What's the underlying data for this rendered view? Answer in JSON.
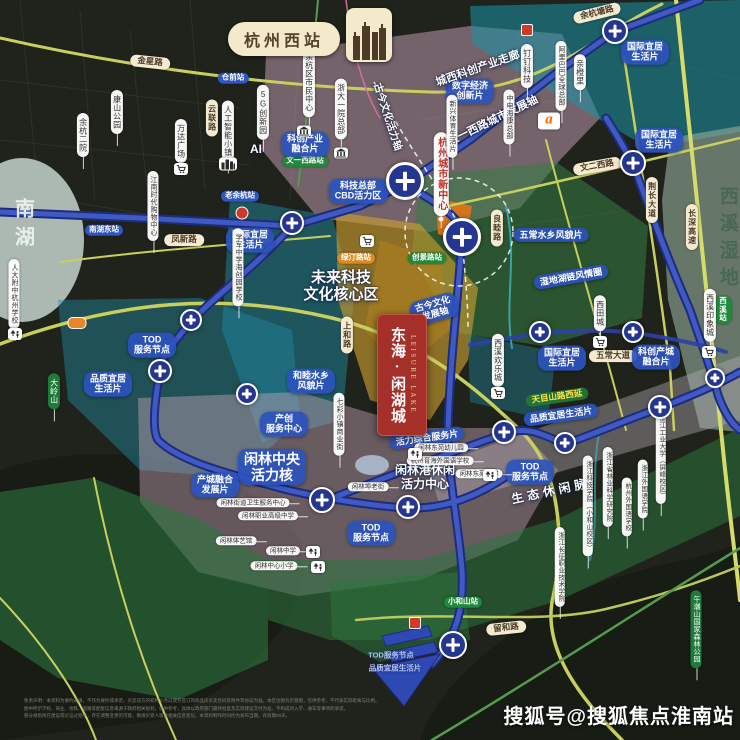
{
  "header": {
    "station_title": "杭州西站"
  },
  "banner": {
    "cn": "东海·闲湖城",
    "en": "LEISURE LAKE"
  },
  "footer": {
    "watermark": "搜狐号@搜狐焦点淮南站",
    "disclaimer_lines": [
      "免责声明：本资料为要约邀请，不作为要约或承诺，买卖双方的权利义务以双方签订的商品房买卖合同及附件等协议为准。本区位图为示意图，仅供参考，不代表实际距离与比例。",
      "图中所示学校、商业、地铁、道路等配套信息来源于政府相关规划，仅供参考，具体以政府部门最终批复及实际建设交付为准，不构成对入学、通车等事项的承诺。",
      "部分规划尚在建设或论证过程中，存在调整变更的可能，敬请买受人留意相关信息变化。本资料制作时间约为发布当期，有效期30天。"
    ]
  },
  "colors": {
    "banner_red": "#a5302a",
    "metro_blue": "#2c41a8",
    "metro_blue_light": "#4159c2",
    "label_blue": "#2b52be",
    "station_green": "#1f8a3c",
    "station_orange": "#e08a1e",
    "station_blue": "#2f55c0",
    "road_yellow": "#c9cf5e",
    "pill_cream": "#f3ead0",
    "wetland_text": "#4a6655"
  },
  "labels": [
    {
      "n": "road-label-jinxinglu",
      "k": "road",
      "t": "金星路",
      "x": 150,
      "y": 62,
      "r": 6
    },
    {
      "n": "road-label-yuhangtanglu",
      "k": "road",
      "t": "余杭塘路",
      "x": 597,
      "y": 13,
      "r": -14
    },
    {
      "n": "road-label-wenerxilu",
      "k": "road",
      "t": "文二西路",
      "x": 597,
      "y": 166,
      "r": -10
    },
    {
      "n": "road-label-fengxinlu",
      "k": "road",
      "t": "凤新路",
      "x": 184,
      "y": 240,
      "r": 0
    },
    {
      "n": "road-label-wuchangdadao",
      "k": "road",
      "t": "五常大道",
      "x": 613,
      "y": 356,
      "r": 0
    },
    {
      "n": "road-label-liuhelu",
      "k": "road",
      "t": "留和路",
      "x": 506,
      "y": 628,
      "r": -6
    },
    {
      "n": "road-label-liangmulu",
      "k": "vroad",
      "t": "良睦路",
      "x": 497,
      "y": 228
    },
    {
      "n": "road-label-jingchangdadao",
      "k": "vroad",
      "t": "荆长大道",
      "x": 652,
      "y": 200
    },
    {
      "n": "road-label-changshengaosu",
      "k": "vroad",
      "t": "长深高速",
      "x": 692,
      "y": 227
    },
    {
      "n": "road-label-shanghelu",
      "k": "vroad",
      "t": "上和路",
      "x": 347,
      "y": 335
    },
    {
      "n": "road-label-yunlianlu",
      "k": "vroad",
      "t": "云联路",
      "x": 212,
      "y": 118
    },
    {
      "n": "station-pill-wenyixilu",
      "k": "st",
      "t": "文一西路站",
      "x": 305,
      "y": 161,
      "c": "g"
    },
    {
      "n": "station-pill-lvtinglu",
      "k": "st",
      "t": "绿汀路站",
      "x": 356,
      "y": 258,
      "c": "o"
    },
    {
      "n": "station-pill-chuangjinglu",
      "k": "st",
      "t": "创景路站",
      "x": 427,
      "y": 258,
      "c": "g"
    },
    {
      "n": "station-pill-xiaoheshan",
      "k": "st",
      "t": "小和山站",
      "x": 463,
      "y": 602,
      "c": "g"
    },
    {
      "n": "station-pill-xixi",
      "k": "st",
      "t": "西溪站",
      "x": 723,
      "y": 310,
      "c": "g"
    },
    {
      "n": "station-pill-nanhudong",
      "k": "st",
      "t": "南湖东站",
      "x": 104,
      "y": 230,
      "c": "b"
    },
    {
      "n": "station-pill-cangqian",
      "k": "st",
      "t": "仓前站",
      "x": 233,
      "y": 78,
      "c": "b"
    },
    {
      "n": "station-pill-laoyuhang",
      "k": "st",
      "t": "老余杭站",
      "x": 240,
      "y": 196,
      "c": "b"
    },
    {
      "n": "zone-label-intl-livable-1",
      "k": "blue",
      "t": "国际宜居\n生活片",
      "x": 645,
      "y": 52
    },
    {
      "n": "zone-label-intl-livable-2",
      "k": "blue",
      "t": "国际宜居\n生活片",
      "x": 659,
      "y": 140
    },
    {
      "n": "zone-label-digital-economy",
      "k": "blue",
      "t": "数字经济\n创新片",
      "x": 470,
      "y": 91
    },
    {
      "n": "zone-label-kechuang-industry",
      "k": "blue",
      "t": "科创产业\n融合片",
      "x": 305,
      "y": 144
    },
    {
      "n": "zone-label-intl-livable-3",
      "k": "blue",
      "t": "国际宜居\n生活片",
      "x": 250,
      "y": 240
    },
    {
      "n": "zone-label-cbd-vitality",
      "k": "blue",
      "t": "科技总部\nCBD活力区",
      "x": 358,
      "y": 191
    },
    {
      "n": "zone-label-wuchang-watertown",
      "k": "blue",
      "t": "五常水乡风貌片",
      "x": 551,
      "y": 235
    },
    {
      "n": "zone-label-wetland-ring",
      "k": "blue",
      "t": "湿地湖链风情圈",
      "x": 571,
      "y": 277,
      "r": -10
    },
    {
      "n": "zone-label-intl-livable-4",
      "k": "blue",
      "t": "国际宜居\n生活片",
      "x": 562,
      "y": 358
    },
    {
      "n": "zone-label-kechuang-city",
      "k": "blue",
      "t": "科创产城\n融合片",
      "x": 656,
      "y": 357
    },
    {
      "n": "zone-label-hemu-watertown",
      "k": "blue",
      "t": "和睦水乡\n风貌片",
      "x": 311,
      "y": 381
    },
    {
      "n": "axis-label-gujin-fazhan",
      "k": "blue",
      "t": "古今文化\n发展轴",
      "x": 434,
      "y": 309,
      "r": -16
    },
    {
      "n": "zone-label-vitality-service",
      "k": "blue",
      "t": "活力综合服务片",
      "x": 427,
      "y": 438,
      "r": -8
    },
    {
      "n": "zone-label-chanchuang-center",
      "k": "blue",
      "t": "产创\n服务中心",
      "x": 284,
      "y": 424
    },
    {
      "n": "zone-label-xianlin-core",
      "k": "blue",
      "t": "闲林中央\n活力核",
      "x": 272,
      "y": 467,
      "s": 14
    },
    {
      "n": "zone-label-chancheng-fusion",
      "k": "blue",
      "t": "产城融合\n发展片",
      "x": 215,
      "y": 485
    },
    {
      "n": "zone-label-quality-livable-1",
      "k": "blue",
      "t": "品质宜居\n生活片",
      "x": 108,
      "y": 384
    },
    {
      "n": "zone-label-tod-node-1",
      "k": "blue",
      "t": "TOD\n服务节点",
      "x": 152,
      "y": 345
    },
    {
      "n": "zone-label-tod-node-2",
      "k": "blue",
      "t": "TOD\n服务节点",
      "x": 530,
      "y": 472
    },
    {
      "n": "zone-label-tod-node-3",
      "k": "blue",
      "t": "TOD\n服务节点",
      "x": 371,
      "y": 533
    },
    {
      "n": "zone-label-quality-livable-2",
      "k": "blue",
      "t": "品质宜居生活片",
      "x": 561,
      "y": 415,
      "r": -8
    },
    {
      "n": "road-label-tianmushanlu",
      "k": "green",
      "t": "天目山路西延",
      "x": 557,
      "y": 397,
      "r": -8
    },
    {
      "n": "zone-label-tod-node-4",
      "k": "faint",
      "t": "TOD服务节点",
      "x": 391,
      "y": 656
    },
    {
      "n": "zone-label-quality-livable-3",
      "k": "faint",
      "t": "品质宜居生活片",
      "x": 395,
      "y": 669
    },
    {
      "n": "zone-label-future-tech-core",
      "k": "wtext",
      "t": "未来科技\n文化核心区",
      "x": 341,
      "y": 286,
      "s": 15
    },
    {
      "n": "zone-label-xianlingang-center",
      "k": "wtext",
      "t": "闲林港休闲\n活力中心",
      "x": 425,
      "y": 478,
      "s": 12
    },
    {
      "n": "axis-label-eco-leisure",
      "k": "wtext",
      "t": "生态休闲脉",
      "x": 551,
      "y": 492,
      "s": 12,
      "r": -12,
      "ls": 4
    },
    {
      "n": "axis-label-chengxi-corridor",
      "k": "wtext",
      "t": "城西科创产业走廊",
      "x": 478,
      "y": 69,
      "s": 11,
      "r": -19
    },
    {
      "n": "axis-label-wenyixilu-axis",
      "k": "wtext",
      "t": "文一西路城市发展轴",
      "x": 493,
      "y": 121,
      "s": 11,
      "r": -26
    },
    {
      "n": "axis-label-gujin-vitality",
      "k": "wtext",
      "t": "古今文化活力轴",
      "x": 387,
      "y": 117,
      "s": 10,
      "r": 72
    },
    {
      "n": "area-label-ai",
      "k": "wtext",
      "t": "AI",
      "x": 256,
      "y": 150,
      "s": 12
    },
    {
      "n": "lake-label-nanhu",
      "k": "vtext",
      "t": "南湖",
      "x": 22,
      "y": 226,
      "s": 20,
      "ls": 8,
      "c": "rgba(238,244,238,0.92)"
    },
    {
      "n": "wetland-label-xixi",
      "k": "vtext",
      "t": "西溪湿地",
      "x": 727,
      "y": 240,
      "s": 19,
      "ls": 8,
      "c": "#4a6655"
    },
    {
      "n": "poi-pill-hz-new-center",
      "k": "redv",
      "t": "杭州城市新中心",
      "x": 441,
      "y": 174
    },
    {
      "n": "poi-pill-kangshan-park",
      "k": "vp",
      "t": "康山公园",
      "x": 117,
      "y": 112
    },
    {
      "n": "poi-pill-yuhang-hospital",
      "k": "vp",
      "t": "余杭二院",
      "x": 83,
      "y": 135
    },
    {
      "n": "poi-pill-wanda-plaza",
      "k": "vp",
      "t": "万达广场",
      "x": 181,
      "y": 141
    },
    {
      "n": "poi-pill-ai-town",
      "k": "vp",
      "t": "人工智能小镇",
      "x": 228,
      "y": 131
    },
    {
      "n": "poi-pill-yuhang-civic-center",
      "k": "vp",
      "t": "余杭区市民中心",
      "x": 309,
      "y": 82
    },
    {
      "n": "poi-pill-5g-park",
      "k": "vp",
      "t": "5G创新园",
      "x": 263,
      "y": 112
    },
    {
      "n": "poi-pill-zheda-hospital",
      "k": "vp",
      "t": "浙大一院总部",
      "x": 341,
      "y": 109
    },
    {
      "n": "poi-pill-dingding",
      "k": "vp",
      "t": "钉钉科技",
      "x": 527,
      "y": 66
    },
    {
      "n": "poi-pill-alibaba-hq",
      "k": "vp",
      "t": "阿里巴巴全球总部",
      "x": 561,
      "y": 76,
      "s": 7
    },
    {
      "n": "poi-pill-qinchengli",
      "k": "vp",
      "t": "亲橙里",
      "x": 580,
      "y": 72
    },
    {
      "n": "poi-pill-cethik",
      "k": "vp",
      "t": "中电海康总部",
      "x": 509,
      "y": 117,
      "s": 7
    },
    {
      "n": "poi-pill-xixi-joyland",
      "k": "vp",
      "t": "西溪欢乐城",
      "x": 498,
      "y": 360
    },
    {
      "n": "poi-pill-xitiancheng",
      "k": "vp",
      "t": "西田城",
      "x": 600,
      "y": 313
    },
    {
      "n": "poi-pill-xixi-intime",
      "k": "vp",
      "t": "西溪印象城",
      "x": 710,
      "y": 315
    },
    {
      "n": "poi-pill-qicai-street",
      "k": "vp",
      "t": "七彩小镇商业街",
      "x": 339,
      "y": 424,
      "s": 7
    },
    {
      "n": "poi-pill-rendafuzhong",
      "k": "vp",
      "t": "人大附中杭州学校",
      "x": 14,
      "y": 294,
      "s": 7
    },
    {
      "n": "poi-pill-xuejun-school",
      "k": "vp",
      "t": "学军中学海创园学校",
      "x": 238,
      "y": 267,
      "s": 7
    },
    {
      "n": "poi-pill-jiangnan-mall",
      "k": "vp",
      "t": "江南时代购物中心",
      "x": 153,
      "y": 206,
      "s": 7
    },
    {
      "n": "poi-pill-sports-life",
      "k": "vp",
      "t": "新兴体育生活片",
      "x": 452,
      "y": 126,
      "s": 7
    },
    {
      "n": "poi-pill-zust",
      "k": "vp",
      "t": "浙江科技学院（小和山校区）",
      "x": 588,
      "y": 506,
      "s": 6.5
    },
    {
      "n": "poi-pill-forestry-academy",
      "k": "vp",
      "t": "浙江省林业科学研究院",
      "x": 608,
      "y": 487,
      "s": 6.5
    },
    {
      "n": "poi-pill-hangzhou-foreign-school",
      "k": "vp",
      "t": "杭州外国语学校",
      "x": 627,
      "y": 507,
      "s": 6.5
    },
    {
      "n": "poi-pill-zisu",
      "k": "vp",
      "t": "浙江外国语学院",
      "x": 643,
      "y": 489,
      "s": 6.5
    },
    {
      "n": "poi-pill-zjut",
      "k": "vp",
      "t": "浙江工业大学（屏峰校区）",
      "x": 661,
      "y": 457,
      "s": 6.5
    },
    {
      "n": "poi-pill-changzheng-college",
      "k": "vp",
      "t": "浙江长征职业技术学院",
      "x": 560,
      "y": 567,
      "s": 6.5
    },
    {
      "n": "poi-pill-daling-mountain",
      "k": "vpg",
      "t": "大岭山",
      "x": 54,
      "y": 391
    },
    {
      "n": "poi-pill-wuchaoshan-park",
      "k": "vpg",
      "t": "午潮山国家森林公园",
      "x": 696,
      "y": 629,
      "s": 7
    },
    {
      "n": "poi-pill-xianlin-health-center",
      "k": "hpill",
      "t": "闲林街道卫生服务中心",
      "x": 253,
      "y": 503
    },
    {
      "n": "poi-pill-xianlin-vocational",
      "k": "hpill",
      "t": "闲林职业高级中学",
      "x": 268,
      "y": 516
    },
    {
      "n": "poi-pill-xianlin-gym",
      "k": "hpill",
      "t": "闲林体艺馆",
      "x": 236,
      "y": 541
    },
    {
      "n": "poi-pill-xianlin-middle-school",
      "k": "hpill",
      "t": "闲林中学",
      "x": 283,
      "y": 551
    },
    {
      "n": "poi-pill-xianlin-primary",
      "k": "hpill",
      "t": "闲林中心小学",
      "x": 274,
      "y": 566
    },
    {
      "n": "poi-pill-xianlinbu-old-street",
      "k": "hpill",
      "t": "闲林埠老街",
      "x": 368,
      "y": 487
    },
    {
      "n": "poi-pill-dongyuan-kindergarten",
      "k": "hpill",
      "t": "闲林东苑幼儿园",
      "x": 441,
      "y": 448
    },
    {
      "n": "poi-pill-yuhai-school",
      "k": "hpill",
      "t": "杭州育海外国语学校",
      "x": 440,
      "y": 461
    },
    {
      "n": "poi-pill-dongyuan-primary",
      "k": "hpill",
      "t": "闲林东苑小学",
      "x": 479,
      "y": 474
    }
  ],
  "icons": [
    {
      "n": "mall-cart-icon-wanda",
      "t": "cart",
      "x": 181,
      "y": 169
    },
    {
      "n": "mall-cart-icon-cbd",
      "t": "cart",
      "x": 367,
      "y": 241
    },
    {
      "n": "mall-cart-icon-joyland",
      "t": "cart",
      "x": 498,
      "y": 393
    },
    {
      "n": "mall-cart-icon-xitiancheng",
      "t": "cart",
      "x": 600,
      "y": 342
    },
    {
      "n": "mall-cart-icon-intime",
      "t": "cart",
      "x": 709,
      "y": 352
    },
    {
      "n": "bank-building-icon-1",
      "t": "bank",
      "x": 304,
      "y": 131
    },
    {
      "n": "bank-building-icon-2",
      "t": "bank",
      "x": 341,
      "y": 153
    },
    {
      "n": "city-buildings-icon",
      "t": "bld",
      "x": 228,
      "y": 164
    },
    {
      "n": "school-icon-rendafuzhong",
      "t": "school",
      "x": 15,
      "y": 334
    },
    {
      "n": "school-icon-xianlin-middle",
      "t": "school",
      "x": 313,
      "y": 552
    },
    {
      "n": "school-icon-xianlin-primary",
      "t": "school",
      "x": 318,
      "y": 567
    },
    {
      "n": "school-icon-yuhai",
      "t": "school",
      "x": 415,
      "y": 454
    },
    {
      "n": "school-icon-dongyuan",
      "t": "school",
      "x": 490,
      "y": 475
    },
    {
      "n": "alibaba-logo-icon",
      "t": "ali",
      "x": 549,
      "y": 121
    },
    {
      "n": "poi-red-icon-1",
      "t": "redsq",
      "x": 527,
      "y": 30
    },
    {
      "n": "poi-red-icon-2",
      "t": "redsq",
      "x": 415,
      "y": 623
    },
    {
      "n": "poi-red-dot-icon",
      "t": "reddot",
      "x": 242,
      "y": 213
    },
    {
      "n": "highway-badge-icon",
      "t": "hwy",
      "x": 77,
      "y": 323
    }
  ],
  "stations": [
    {
      "x": 405,
      "y": 181,
      "r": 19
    },
    {
      "x": 462,
      "y": 237,
      "r": 19
    },
    {
      "x": 615,
      "y": 31,
      "r": 13
    },
    {
      "x": 292,
      "y": 223,
      "r": 12
    },
    {
      "x": 633,
      "y": 163,
      "r": 13
    },
    {
      "x": 191,
      "y": 320,
      "r": 11
    },
    {
      "x": 160,
      "y": 371,
      "r": 12
    },
    {
      "x": 247,
      "y": 394,
      "r": 11
    },
    {
      "x": 322,
      "y": 500,
      "r": 13
    },
    {
      "x": 408,
      "y": 507,
      "r": 12
    },
    {
      "x": 540,
      "y": 332,
      "r": 11
    },
    {
      "x": 633,
      "y": 332,
      "r": 11
    },
    {
      "x": 660,
      "y": 407,
      "r": 12
    },
    {
      "x": 504,
      "y": 432,
      "r": 12
    },
    {
      "x": 565,
      "y": 443,
      "r": 11
    },
    {
      "x": 453,
      "y": 645,
      "r": 14
    },
    {
      "x": 715,
      "y": 378,
      "r": 10
    }
  ]
}
